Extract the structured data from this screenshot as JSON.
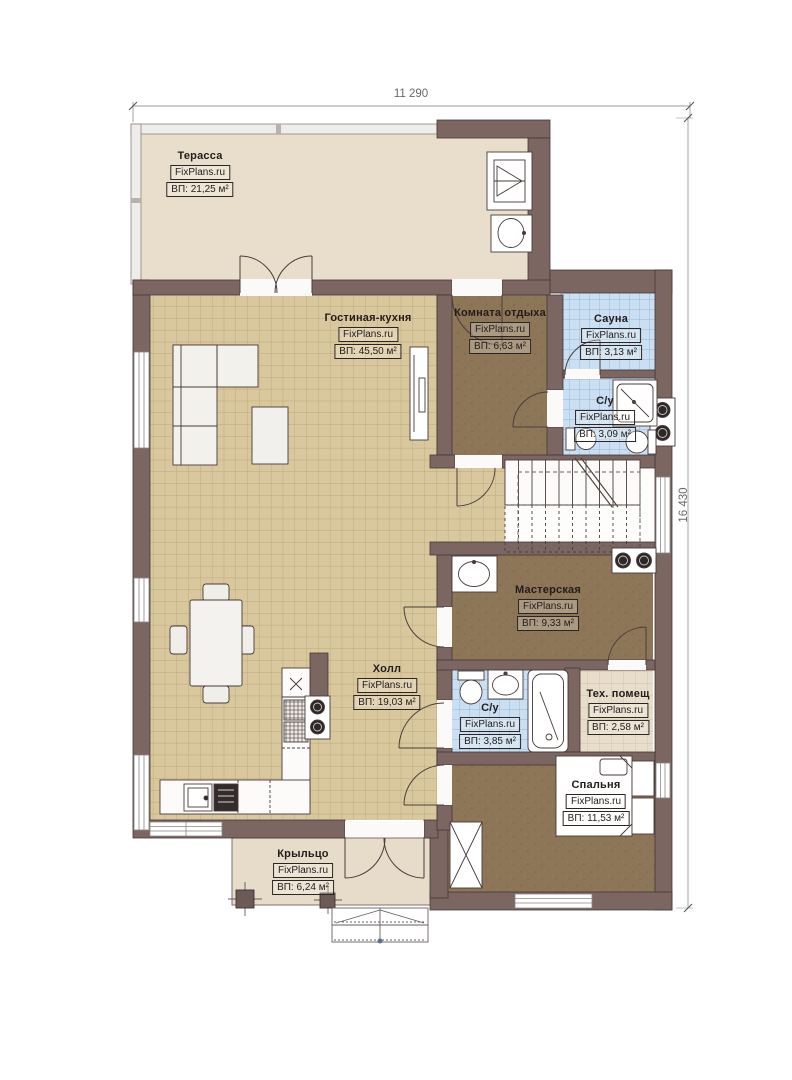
{
  "watermark": "FixPlans.ru",
  "dimensions": {
    "top": "11 290",
    "right": "16 430"
  },
  "rooms": [
    {
      "key": "terrace",
      "name": "Терасса",
      "area": "ВП: 21,25 м²"
    },
    {
      "key": "living",
      "name": "Гостиная-кухня",
      "area": "ВП: 45,50 м²"
    },
    {
      "key": "lounge",
      "name": "Комната отдыха",
      "area": "ВП: 6,63 м²"
    },
    {
      "key": "sauna",
      "name": "Сауна",
      "area": "ВП: 3,13 м²"
    },
    {
      "key": "wc-top",
      "name": "С/у",
      "area": "ВП: 3,09 м²"
    },
    {
      "key": "workshop",
      "name": "Мастерская",
      "area": "ВП: 9,33 м²"
    },
    {
      "key": "hall",
      "name": "Холл",
      "area": "ВП: 19,03 м²"
    },
    {
      "key": "wc-bottom",
      "name": "С/у",
      "area": "ВП: 3,85 м²"
    },
    {
      "key": "tech",
      "name": "Тех. помещ",
      "area": "ВП: 2,58 м²"
    },
    {
      "key": "bedroom",
      "name": "Спальня",
      "area": "ВП: 11,53 м²"
    },
    {
      "key": "porch",
      "name": "Крыльцо",
      "area": "ВП: 6,24 м²"
    }
  ],
  "colors": {
    "wall": "#7b6662",
    "floor_tile_tan": "#d9c89e",
    "floor_brown": "#8d7557",
    "floor_tile_blue": "#cadff2",
    "floor_beige": "#e8decb"
  }
}
